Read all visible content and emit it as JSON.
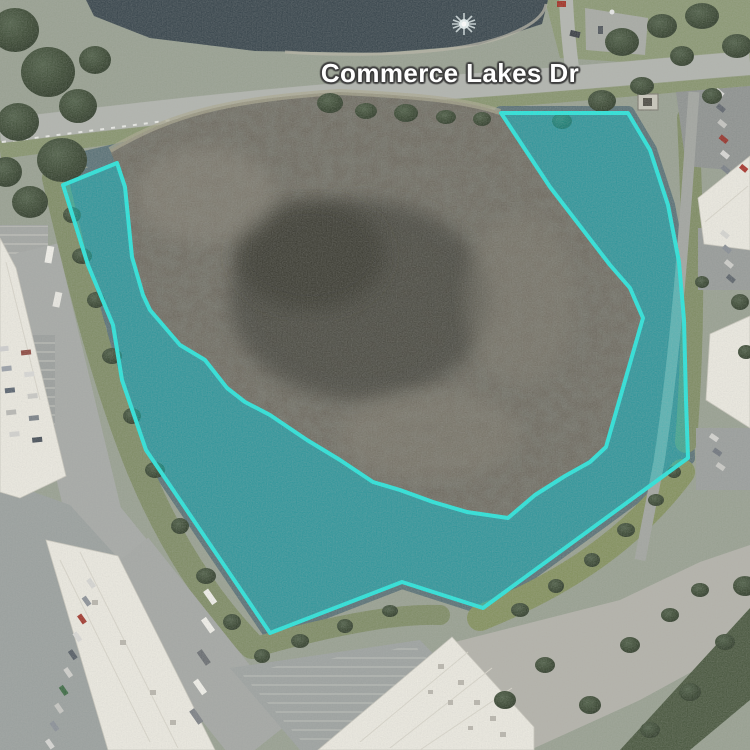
{
  "map": {
    "road_label": "Commerce Lakes Dr",
    "selection": {
      "points": "501,113 628,113 650,150 668,205 679,262 684,320 686,400 688,458 483,608 402,582 270,633 146,450 122,380 113,325 88,265 63,185 117,163 125,187 132,257 143,295 150,310 180,345 205,360 227,388 245,402 270,415 307,440 340,460 373,482 400,490 433,502 467,512 508,518 535,495 565,476 590,462 606,447 643,318 630,288 610,265 550,187",
      "stroke_color": "#2ae3da",
      "fill_color": "rgba(0,195,200,0.45)",
      "stroke_width": "4"
    },
    "palette": {
      "water": "#5b7277",
      "pond": "#39464d",
      "marsh_island": "#6e6a60",
      "grass": "#7f8c66",
      "pavement": "#9ba09f",
      "roof": "#ebe9e0"
    }
  }
}
